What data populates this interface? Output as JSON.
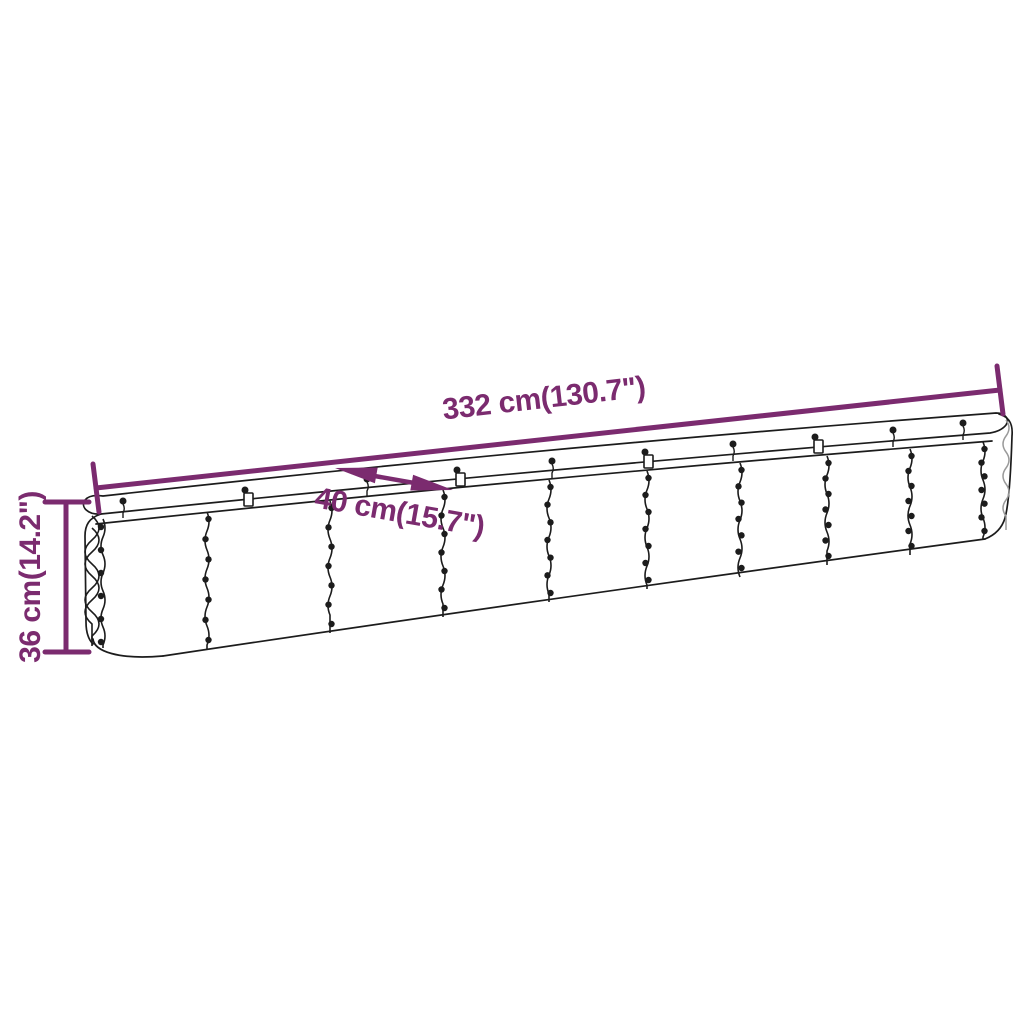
{
  "page": {
    "background": "#ffffff"
  },
  "diagram": {
    "kind": "product-dimension-diagram",
    "subject": "corrugated steel raised garden bed",
    "accent_color": "#7B2B6F",
    "line_color": "#1c1c1c",
    "corrugation_shadow_color": "#9a9a9a",
    "dimensions": {
      "length": {
        "label": "332 cm(130.7\")",
        "value_cm": 332,
        "value_inch": 130.7
      },
      "width": {
        "label": "40 cm(15.7\")",
        "value_cm": 40,
        "value_inch": 15.7
      },
      "height": {
        "label": "36 cm(14.2\")",
        "value_cm": 36,
        "value_inch": 14.2
      }
    }
  }
}
